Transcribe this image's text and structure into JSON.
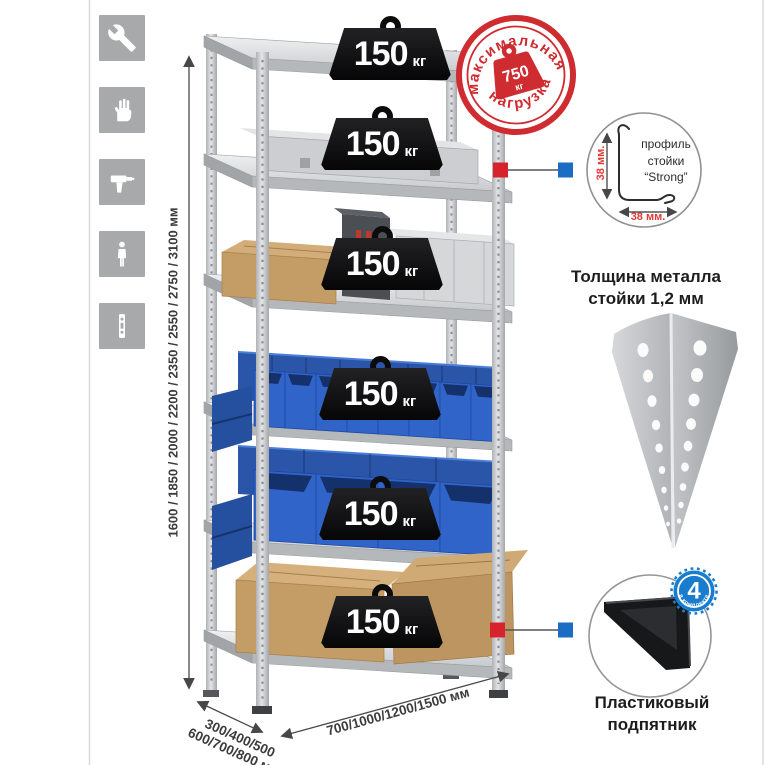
{
  "sidebar": {
    "icons": [
      {
        "name": "wrench-icon"
      },
      {
        "name": "gloves-icon"
      },
      {
        "name": "drill-icon"
      },
      {
        "name": "person-icon"
      },
      {
        "name": "profile-strip-icon"
      }
    ]
  },
  "rack": {
    "shelves": [
      {
        "load": "150",
        "unit": "кг"
      },
      {
        "load": "150",
        "unit": "кг"
      },
      {
        "load": "150",
        "unit": "кг"
      },
      {
        "load": "150",
        "unit": "кг"
      },
      {
        "load": "150",
        "unit": "кг"
      },
      {
        "load": "150",
        "unit": "кг"
      }
    ]
  },
  "max_load_stamp": {
    "arc_top": "максимальная",
    "arc_bottom": "нагрузка",
    "value": "750",
    "unit": "кг"
  },
  "dimensions": {
    "height": "1600 / 1850 / 2000 / 2200 / 2350 / 2550 / 2750 / 3100 мм",
    "depth_line1": "300/400/500",
    "depth_line2": "600/700/800 мм",
    "width": "700/1000/1200/1500 мм"
  },
  "profile_detail": {
    "label_line1": "профиль",
    "label_line2": "стойки",
    "label_line3": "“Strong”",
    "dim_v": "38 мм.",
    "dim_h": "38 мм.",
    "caption_line1": "Толщина металла",
    "caption_line2": "стойки 1,2 мм"
  },
  "foot_detail": {
    "badge_value": "4",
    "badge_arc": "в комплекте",
    "caption_line1": "Пластиковый",
    "caption_line2": "подпятник"
  },
  "colors": {
    "accent_red": "#ce2c31",
    "accent_blue": "#1a6cc4",
    "bin_blue": "#3064c9",
    "carton": "#c49c66",
    "metal": "#cdd0d3",
    "tile_gray": "#a7a9ab"
  }
}
